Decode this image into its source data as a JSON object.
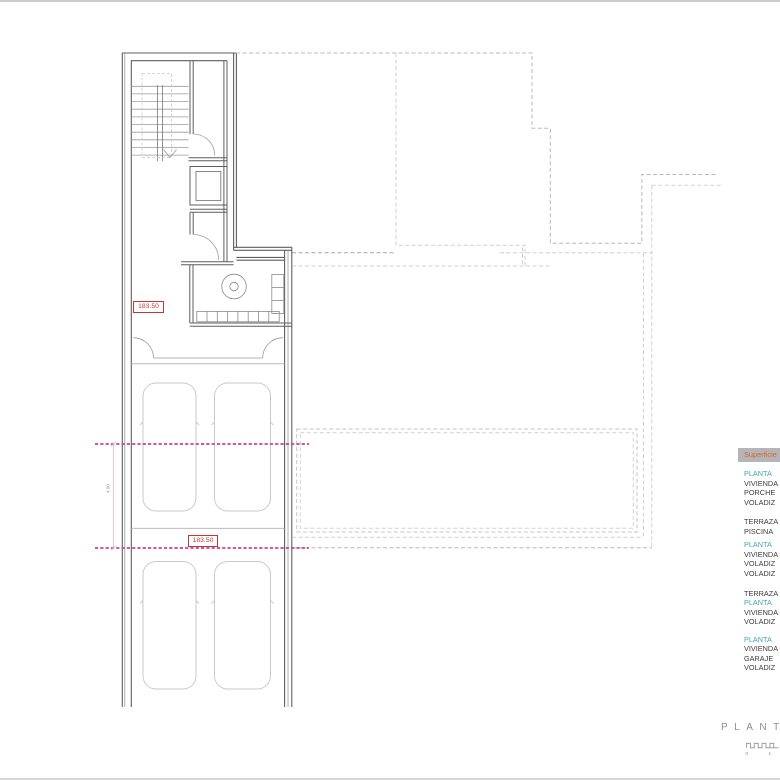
{
  "plan": {
    "area_labels": [
      {
        "value": "183.50"
      },
      {
        "value": "183.50"
      }
    ],
    "dimension_label": "4.90"
  },
  "legend": {
    "header": "Superficie",
    "rows": [
      {
        "label": "PLANTA"
      },
      {
        "label": "VIVIENDA"
      },
      {
        "label": "PORCHE"
      },
      {
        "label": "VOLADIZ"
      },
      {
        "label": "TERRAZA"
      },
      {
        "label": "PISCINA"
      },
      {
        "label": "PLANTA"
      },
      {
        "label": "VIVIENDA"
      },
      {
        "label": "VOLADIZ"
      },
      {
        "label": "VOLADIZ"
      },
      {
        "label": "TERRAZA"
      },
      {
        "label": "PLANTA"
      },
      {
        "label": "VIVIENDA"
      },
      {
        "label": "VOLADIZ"
      },
      {
        "label": "PLANTA"
      },
      {
        "label": "VIVIENDA"
      },
      {
        "label": "GARAJE"
      },
      {
        "label": "VOLADIZ"
      }
    ]
  },
  "titleblock": {
    "title": "PLANT",
    "scale": {
      "start": "0",
      "end": "1"
    }
  },
  "colors": {
    "wall_line": "#5f5f5f",
    "dashed_outline": "#b8b8b8",
    "section_line_magenta": "#c93fa4",
    "area_label_red": "#c23b2e",
    "legend_header_text": "#d46426",
    "legend_header_bg": "#b5b5b9",
    "legend_accent_teal": "#3da7b0",
    "title_gray": "#8d8d8d"
  }
}
